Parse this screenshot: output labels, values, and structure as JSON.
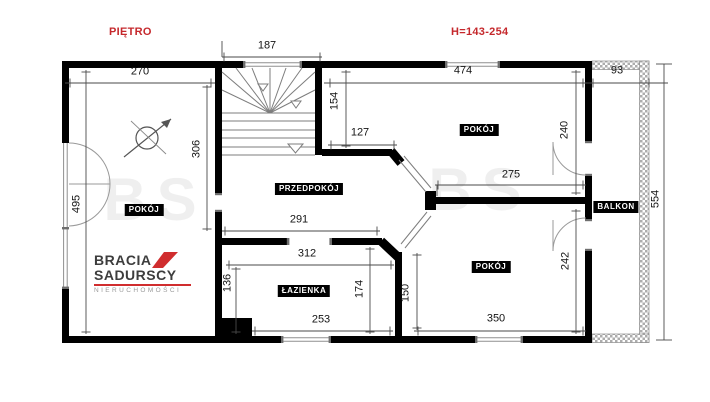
{
  "header": {
    "floor_label": "PIĘTRO",
    "height_note": "H=143-254"
  },
  "rooms": {
    "pokoj_left": "POKÓJ",
    "przedpokoj": "PRZEDPOKÓJ",
    "pokoj_top_right": "POKÓJ",
    "pokoj_bottom_right": "POKÓJ",
    "lazienka": "ŁAZIENKA",
    "balkon": "BALKON"
  },
  "dimensions": {
    "left_room_width": "270",
    "stairs_width": "187",
    "top_right_width": "474",
    "balcony_width": "93",
    "left_wall_height": "495",
    "left_room_height": "306",
    "stairs_height": "154",
    "hall_top_width": "127",
    "top_right_room_height": "240",
    "top_right_room_width": "275",
    "hall_width": "291",
    "bath_top_width": "312",
    "bath_left_height": "136",
    "bath_right_height": "174",
    "nook_height": "150",
    "bath_bottom_width": "253",
    "bottom_right_width": "350",
    "bottom_right_height": "242",
    "right_total_height": "554"
  },
  "logo": {
    "brand_line1": "BRACIA",
    "brand_line2": "SADURSCY",
    "brand_line3": "NIERUCHOMOŚCI"
  },
  "watermark": {
    "text": "BS"
  },
  "colors": {
    "accent_red": "#c5282c",
    "wall_black": "#000000"
  }
}
